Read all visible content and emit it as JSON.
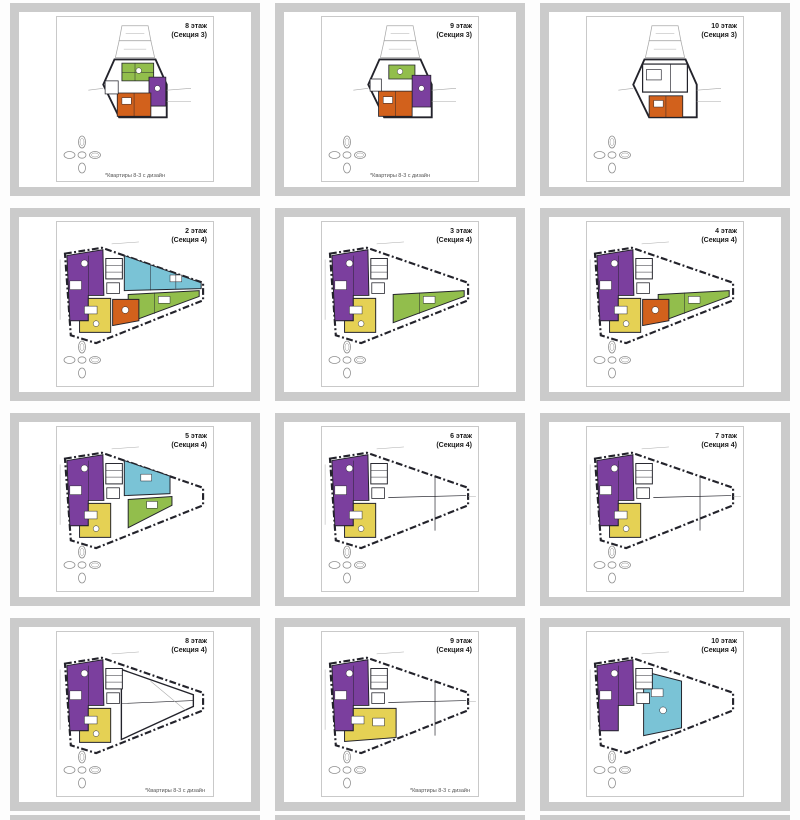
{
  "colors": {
    "purple": "#7B3F9E",
    "teal": "#7AC3D6",
    "green": "#92BE4C",
    "yellow": "#E5D154",
    "orange": "#D2611C",
    "wall": "#23232B",
    "faint": "#A9A9A9",
    "comp": "#8F8F8F",
    "frame": "#CBCBCB"
  },
  "tiles": [
    {
      "floor": "8 этаж",
      "section": "(Секция 3)",
      "plan": "s3a",
      "caption": "*Квартиры 8-3 с дизайн",
      "cap": "center"
    },
    {
      "floor": "9 этаж",
      "section": "(Секция 3)",
      "plan": "s3b",
      "caption": "*Квартиры 8-3 с дизайн",
      "cap": "center"
    },
    {
      "floor": "10 этаж",
      "section": "(Секция 3)",
      "plan": "s3c",
      "caption": "",
      "cap": "center"
    },
    {
      "floor": "2 этаж",
      "section": "(Секция 4)",
      "plan": "s4a",
      "caption": "",
      "cap": "center"
    },
    {
      "floor": "3 этаж",
      "section": "(Секция 4)",
      "plan": "s4b",
      "caption": "",
      "cap": "center"
    },
    {
      "floor": "4 этаж",
      "section": "(Секция 4)",
      "plan": "s4c",
      "caption": "",
      "cap": "center"
    },
    {
      "floor": "5 этаж",
      "section": "(Секция 4)",
      "plan": "s4d",
      "caption": "",
      "cap": "center"
    },
    {
      "floor": "6 этаж",
      "section": "(Секция 4)",
      "plan": "s4e",
      "caption": "",
      "cap": "center"
    },
    {
      "floor": "7 этаж",
      "section": "(Секция 4)",
      "plan": "s4e",
      "caption": "",
      "cap": "center"
    },
    {
      "floor": "8 этаж",
      "section": "(Секция 4)",
      "plan": "s4f",
      "caption": "*Квартиры 8-3 с дизайн",
      "cap": "right"
    },
    {
      "floor": "9 этаж",
      "section": "(Секция 4)",
      "plan": "s4g",
      "caption": "*Квартиры 8-3 с дизайн",
      "cap": "right"
    },
    {
      "floor": "10 этаж",
      "section": "(Секция 4)",
      "plan": "s4h",
      "caption": "",
      "cap": "center"
    }
  ],
  "plans": {
    "s3a": {
      "vb": "0 0 160 120",
      "g": [
        "s3base",
        "s3a_units"
      ]
    },
    "s3b": {
      "vb": "0 0 160 120",
      "g": [
        "s3base",
        "s3b_units"
      ]
    },
    "s3c": {
      "vb": "0 0 160 120",
      "g": [
        "s3base",
        "s3c_units"
      ]
    },
    "s4a": {
      "vb": "0 0 160 110",
      "g": [
        "s4base",
        "purple4",
        "core4",
        "teal4",
        "green4",
        "yellow4",
        "orange4"
      ]
    },
    "s4b": {
      "vb": "0 0 160 110",
      "g": [
        "s4base",
        "purple4",
        "core4",
        "green4",
        "yellow4"
      ]
    },
    "s4c": {
      "vb": "0 0 160 110",
      "g": [
        "s4base",
        "purple4",
        "core4",
        "green4",
        "yellow4",
        "orange4"
      ]
    },
    "s4d": {
      "vb": "0 0 160 110",
      "g": [
        "s4base",
        "purple4",
        "core4",
        "teal4short",
        "green4short",
        "yellow4"
      ]
    },
    "s4e": {
      "vb": "0 0 160 110",
      "g": [
        "s4base",
        "white4mid",
        "purple4",
        "core4",
        "yellow4"
      ]
    },
    "s4f": {
      "vb": "0 0 160 110",
      "g": [
        "s4base",
        "s4f_detail",
        "purple4",
        "core4",
        "yellow4"
      ]
    },
    "s4g": {
      "vb": "0 0 160 110",
      "g": [
        "s4base",
        "white4mid",
        "purple4",
        "core4",
        "yellow4wide"
      ]
    },
    "s4h": {
      "vb": "0 0 160 110",
      "g": [
        "s4base",
        "purple4",
        "teal4center",
        "core4"
      ]
    }
  },
  "groups": {
    "s3base": [
      {
        "t": "p",
        "p": "66,3 94,3 97,19 63,19",
        "f": "#ffffff",
        "s": "faint",
        "w": 0.8
      },
      {
        "t": "p",
        "p": "63,19 97,19 101,37 59,37",
        "f": "#ffffff",
        "s": "faint",
        "w": 0.8
      },
      {
        "t": "l",
        "p": [
          70,
          11,
          90,
          11
        ],
        "s": "faint",
        "w": 0.5
      },
      {
        "t": "l",
        "p": [
          68,
          28,
          92,
          28
        ],
        "s": "faint",
        "w": 0.5
      },
      {
        "t": "p",
        "p": "58,39 102,39 114,66 114,101 63,101 46,66",
        "f": "#ffffff",
        "s": "wall",
        "w": 2
      },
      {
        "t": "l",
        "p": [
          114,
          72,
          140,
          70
        ],
        "s": "faint",
        "w": 0.6
      },
      {
        "t": "l",
        "p": [
          114,
          84,
          140,
          84
        ],
        "s": "faint",
        "w": 0.6
      },
      {
        "t": "l",
        "p": [
          46,
          70,
          30,
          72
        ],
        "s": "faint",
        "w": 0.6
      }
    ],
    "s3a_units": [
      {
        "t": "p",
        "p": "66,43 100,43 100,62 66,62",
        "f": "green",
        "s": "wall",
        "w": 0.9
      },
      {
        "t": "l",
        "p": [
          80,
          43,
          80,
          62
        ],
        "s": "wall",
        "w": 0.5
      },
      {
        "t": "l",
        "p": [
          66,
          53,
          100,
          53
        ],
        "s": "wall",
        "w": 0.5
      },
      {
        "t": "p",
        "p": "95,58 113,58 113,89 95,89",
        "f": "purple",
        "s": "wall",
        "w": 0.9
      },
      {
        "t": "c",
        "p": [
          104,
          70,
          3
        ],
        "f": "#ffffff",
        "s": "wall",
        "w": 0.5
      },
      {
        "t": "p",
        "p": "61,75 97,75 97,100 61,100",
        "f": "orange",
        "s": "wall",
        "w": 0.9
      },
      {
        "t": "r",
        "p": [
          66,
          80,
          10,
          7
        ],
        "f": "#ffffff",
        "s": "wall",
        "w": 0.5
      },
      {
        "t": "l",
        "p": [
          79,
          75,
          79,
          100
        ],
        "s": "wall",
        "w": 0.5
      },
      {
        "t": "r",
        "p": [
          48,
          62,
          14,
          14
        ],
        "f": "#ffffff",
        "s": "wall",
        "w": 0.8
      },
      {
        "t": "c",
        "p": [
          84,
          51,
          3
        ],
        "f": "#ffffff",
        "s": "wall",
        "w": 0.5
      }
    ],
    "s3b_units": [
      {
        "t": "p",
        "p": "68,45 96,45 96,60 68,60",
        "f": "green",
        "s": "wall",
        "w": 0.9
      },
      {
        "t": "p",
        "p": "93,56 113,56 113,90 93,90",
        "f": "purple",
        "s": "wall",
        "w": 0.9
      },
      {
        "t": "c",
        "p": [
          103,
          70,
          3
        ],
        "f": "#ffffff",
        "s": "wall",
        "w": 0.5
      },
      {
        "t": "p",
        "p": "57,73 93,73 93,100 57,100",
        "f": "orange",
        "s": "wall",
        "w": 0.9
      },
      {
        "t": "r",
        "p": [
          62,
          79,
          10,
          7
        ],
        "f": "#ffffff",
        "s": "wall",
        "w": 0.5
      },
      {
        "t": "l",
        "p": [
          75,
          73,
          75,
          100
        ],
        "s": "wall",
        "w": 0.5
      },
      {
        "t": "r",
        "p": [
          48,
          60,
          12,
          13
        ],
        "f": "#ffffff",
        "s": "wall",
        "w": 0.8
      },
      {
        "t": "c",
        "p": [
          80,
          52,
          3
        ],
        "f": "#ffffff",
        "s": "wall",
        "w": 0.5
      }
    ],
    "s3c_units": [
      {
        "t": "r",
        "p": [
          56,
          44,
          48,
          30
        ],
        "f": "#ffffff",
        "s": "wall",
        "w": 1.3
      },
      {
        "t": "r",
        "p": [
          60,
          50,
          16,
          11
        ],
        "f": "#ffffff",
        "s": "wall",
        "w": 0.7
      },
      {
        "t": "l",
        "p": [
          86,
          44,
          86,
          74
        ],
        "s": "wall",
        "w": 0.7
      },
      {
        "t": "p",
        "p": "63,78 99,78 99,101 63,101",
        "f": "orange",
        "s": "wall",
        "w": 0.9
      },
      {
        "t": "r",
        "p": [
          68,
          83,
          10,
          7
        ],
        "f": "#ffffff",
        "s": "wall",
        "w": 0.5
      },
      {
        "t": "l",
        "p": [
          81,
          78,
          81,
          101
        ],
        "s": "wall",
        "w": 0.5
      }
    ],
    "s4base": [
      {
        "t": "p",
        "p": "8,14 46,8 150,44 150,62 40,106 14,98",
        "f": "#ffffff",
        "s": "wall",
        "w": 2.2,
        "d": "7 2.5 2 2.5"
      },
      {
        "t": "l",
        "p": [
          3,
          20,
          3,
          82
        ],
        "s": "faint",
        "w": 0.5
      },
      {
        "t": "l",
        "p": [
          56,
          4,
          84,
          2
        ],
        "s": "faint",
        "w": 0.5
      }
    ],
    "core4": [
      {
        "t": "r",
        "p": [
          50,
          19,
          17,
          21
        ],
        "f": "#ffffff",
        "s": "wall",
        "w": 1
      },
      {
        "t": "l",
        "p": [
          50,
          26,
          67,
          26
        ],
        "s": "wall",
        "w": 0.5
      },
      {
        "t": "l",
        "p": [
          50,
          33,
          67,
          33
        ],
        "s": "wall",
        "w": 0.5
      },
      {
        "t": "r",
        "p": [
          51,
          44,
          13,
          11
        ],
        "f": "#ffffff",
        "s": "wall",
        "w": 0.8
      }
    ],
    "purple4": [
      {
        "t": "p",
        "p": "10,16 47,10 48,57 32,57 32,83 13,83",
        "f": "purple",
        "s": "wall",
        "w": 1
      },
      {
        "t": "c",
        "p": [
          28,
          24,
          3.5
        ],
        "f": "#ffffff",
        "s": "wall",
        "w": 0.5
      },
      {
        "t": "r",
        "p": [
          13,
          42,
          12,
          9
        ],
        "f": "#ffffff",
        "s": "wall",
        "w": 0.5
      },
      {
        "t": "l",
        "p": [
          32,
          16,
          32,
          57
        ],
        "s": "wall",
        "w": 0.5
      }
    ],
    "teal4": [
      {
        "t": "p",
        "p": "69,16 148,44 148,50 69,52",
        "f": "teal",
        "s": "wall",
        "w": 1
      },
      {
        "t": "r",
        "p": [
          116,
          36,
          12,
          7
        ],
        "f": "#ffffff",
        "s": "wall",
        "w": 0.5
      },
      {
        "t": "l",
        "p": [
          96,
          26,
          96,
          52
        ],
        "s": "wall",
        "w": 0.5
      },
      {
        "t": "l",
        "p": [
          122,
          35,
          122,
          50
        ],
        "s": "wall",
        "w": 0.5
      }
    ],
    "green4": [
      {
        "t": "p",
        "p": "73,56 146,52 146,58 73,85",
        "f": "green",
        "s": "wall",
        "w": 1
      },
      {
        "t": "r",
        "p": [
          104,
          58,
          12,
          7
        ],
        "f": "#ffffff",
        "s": "wall",
        "w": 0.5
      },
      {
        "t": "l",
        "p": [
          100,
          54,
          100,
          76
        ],
        "s": "wall",
        "w": 0.5
      }
    ],
    "yellow4": [
      {
        "t": "p",
        "p": "32,60 55,60 55,95 23,95 23,83 32,83",
        "f": "yellow",
        "s": "wall",
        "w": 1
      },
      {
        "t": "r",
        "p": [
          28,
          68,
          13,
          8
        ],
        "f": "#ffffff",
        "s": "wall",
        "w": 0.5
      },
      {
        "t": "c",
        "p": [
          40,
          86,
          3
        ],
        "f": "#ffffff",
        "s": "wall",
        "w": 0.5
      }
    ],
    "orange4": [
      {
        "t": "p",
        "p": "57,61 84,61 84,83 57,88",
        "f": "orange",
        "s": "wall",
        "w": 1
      },
      {
        "t": "c",
        "p": [
          70,
          72,
          3.5
        ],
        "f": "#ffffff",
        "s": "wall",
        "w": 0.5
      }
    ],
    "teal4short": [
      {
        "t": "p",
        "p": "69,16 116,32 116,50 69,52",
        "f": "teal",
        "s": "wall",
        "w": 1
      },
      {
        "t": "r",
        "p": [
          86,
          30,
          11,
          7
        ],
        "f": "#ffffff",
        "s": "wall",
        "w": 0.5
      }
    ],
    "green4short": [
      {
        "t": "p",
        "p": "73,56 118,53 118,62 73,85",
        "f": "green",
        "s": "wall",
        "w": 1
      },
      {
        "t": "r",
        "p": [
          92,
          58,
          11,
          7
        ],
        "f": "#ffffff",
        "s": "wall",
        "w": 0.5
      }
    ],
    "white4mid": [
      {
        "t": "l",
        "p": [
          68,
          54,
          148,
          52
        ],
        "s": "wall",
        "w": 0.7
      },
      {
        "t": "l",
        "p": [
          116,
          32,
          116,
          88
        ],
        "s": "wall",
        "w": 0.7
      },
      {
        "t": "l",
        "p": [
          150,
          53,
          158,
          53
        ],
        "s": "faint",
        "w": 0.5
      }
    ],
    "s4f_detail": [
      {
        "t": "p",
        "p": "66,20 140,46 140,58 66,92",
        "f": "#ffffff",
        "s": "wall",
        "w": 1.4
      },
      {
        "t": "l",
        "p": [
          66,
          55,
          140,
          52
        ],
        "s": "wall",
        "w": 0.6
      },
      {
        "t": "l",
        "p": [
          96,
          32,
          132,
          62
        ],
        "s": "faint",
        "w": 0.6
      }
    ],
    "yellow4wide": [
      {
        "t": "p",
        "p": "32,60 76,60 76,90 23,94 23,83 32,83",
        "f": "yellow",
        "s": "wall",
        "w": 1
      },
      {
        "t": "r",
        "p": [
          30,
          68,
          13,
          8
        ],
        "f": "#ffffff",
        "s": "wall",
        "w": 0.5
      },
      {
        "t": "r",
        "p": [
          52,
          70,
          12,
          8
        ],
        "f": "#ffffff",
        "s": "wall",
        "w": 0.5
      }
    ],
    "teal4center": [
      {
        "t": "p",
        "p": "58,22 97,32 97,80 58,88",
        "f": "teal",
        "s": "wall",
        "w": 1
      },
      {
        "t": "r",
        "p": [
          66,
          40,
          12,
          8
        ],
        "f": "#ffffff",
        "s": "wall",
        "w": 0.5
      },
      {
        "t": "c",
        "p": [
          78,
          62,
          3.5
        ],
        "f": "#ffffff",
        "s": "wall",
        "w": 0.5
      }
    ],
    "compass": [
      {
        "t": "e",
        "p": [
          19,
          7,
          3.5,
          6
        ],
        "f": "#ffffff",
        "s": "comp",
        "w": 0.8
      },
      {
        "t": "e",
        "p": [
          19,
          7,
          2,
          3.5
        ],
        "f": "none",
        "s": "comp",
        "w": 0.5
      },
      {
        "t": "e",
        "p": [
          6.5,
          20,
          5.5,
          3.5
        ],
        "f": "#ffffff",
        "s": "comp",
        "w": 0.8
      },
      {
        "t": "e",
        "p": [
          19,
          20,
          4,
          3.2
        ],
        "f": "#ffffff",
        "s": "comp",
        "w": 0.8
      },
      {
        "t": "e",
        "p": [
          32,
          20,
          5.5,
          3.5
        ],
        "f": "#ffffff",
        "s": "comp",
        "w": 0.8
      },
      {
        "t": "e",
        "p": [
          32,
          20,
          3.5,
          2
        ],
        "f": "none",
        "s": "comp",
        "w": 0.5
      },
      {
        "t": "e",
        "p": [
          19,
          33,
          3.5,
          5
        ],
        "f": "#ffffff",
        "s": "comp",
        "w": 0.8
      }
    ]
  }
}
